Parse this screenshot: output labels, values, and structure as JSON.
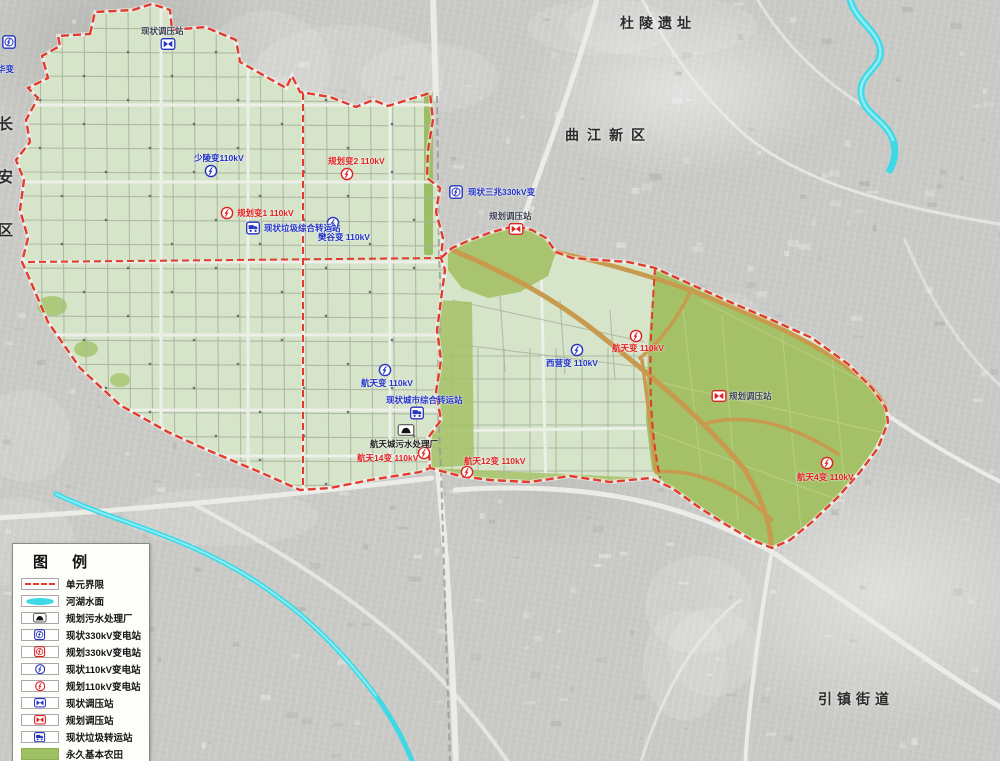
{
  "legend": {
    "title": "图 例",
    "items": [
      {
        "id": "unit-boundary",
        "swatch": "dashed-line",
        "label": "单元界限"
      },
      {
        "id": "water-surface",
        "swatch": "water",
        "label": "河湖水面"
      },
      {
        "id": "sewage-plant-planned",
        "swatch": "sewage",
        "label": "规划污水处理厂"
      },
      {
        "id": "substation-330-existing",
        "swatch": "sub330-blue",
        "label": "现状330kV变电站"
      },
      {
        "id": "substation-330-planned",
        "swatch": "sub330-red",
        "label": "规划330kV变电站"
      },
      {
        "id": "substation-110-existing",
        "swatch": "sub110-blue",
        "label": "现状110kV变电站"
      },
      {
        "id": "substation-110-planned",
        "swatch": "sub110-red",
        "label": "规划110kV变电站"
      },
      {
        "id": "regulator-existing",
        "swatch": "reg-blue",
        "label": "现状调压站"
      },
      {
        "id": "regulator-planned",
        "swatch": "reg-red",
        "label": "规划调压站"
      },
      {
        "id": "garbage-transfer-existing",
        "swatch": "garbage-blue",
        "label": "现状垃圾转运站"
      },
      {
        "id": "permanent-farmland",
        "swatch": "farmland",
        "label": "永久基本农田"
      }
    ]
  },
  "map": {
    "place_labels": [
      {
        "id": "duling-ruins",
        "text": "杜陵遗址",
        "x": 620,
        "y": 13,
        "size": 14,
        "spacing": 5,
        "vertical": false
      },
      {
        "id": "qujiang-new-district",
        "text": "曲江新区",
        "x": 565,
        "y": 125,
        "size": 14,
        "spacing": 8,
        "vertical": false
      },
      {
        "id": "yinzhen-subdistrict",
        "text": "引镇街道",
        "x": 818,
        "y": 689,
        "size": 14,
        "spacing": 5,
        "vertical": false
      },
      {
        "id": "changan-district",
        "text": "长安区",
        "x": -6,
        "y": 116,
        "size": 15,
        "spacing": 38,
        "vertical": true
      }
    ],
    "markers": [
      {
        "id": "substation-west-edge",
        "icon": "sub330",
        "color": "blue",
        "x": 9,
        "y": 42,
        "label": "华变",
        "lx": -3,
        "ly": 63,
        "lc": "blue"
      },
      {
        "id": "regulator-existing-north",
        "icon": "regulator",
        "color": "blue",
        "x": 168,
        "y": 44,
        "label": "现状调压站",
        "lx": 141,
        "ly": 25,
        "lc": "dark"
      },
      {
        "id": "substation-110-shaoling",
        "icon": "sub110",
        "color": "blue",
        "x": 211,
        "y": 171,
        "label": "少陵变110kV",
        "lx": 194,
        "ly": 152,
        "lc": "blue"
      },
      {
        "id": "substation-110-planned-2",
        "icon": "sub110",
        "color": "red",
        "x": 347,
        "y": 174,
        "label": "规划变2 110kV",
        "lx": 328,
        "ly": 155,
        "lc": "red"
      },
      {
        "id": "substation-110-planned-1",
        "icon": "sub110",
        "color": "red",
        "x": 227,
        "y": 213,
        "label": "规划变1 110kV",
        "lx": 237,
        "ly": 207,
        "lc": "red"
      },
      {
        "id": "garbage-transfer-existing",
        "icon": "garbage",
        "color": "blue",
        "x": 253,
        "y": 228,
        "label": "现状垃圾综合转运站",
        "lx": 264,
        "ly": 222,
        "lc": "blue"
      },
      {
        "id": "substation-110-fangu",
        "icon": "sub110",
        "color": "blue",
        "x": 333,
        "y": 223,
        "label": "樊谷变 110kV",
        "lx": 318,
        "ly": 231,
        "lc": "blue"
      },
      {
        "id": "substation-330-sanzhao",
        "icon": "sub330",
        "color": "blue",
        "x": 456,
        "y": 192,
        "label": "现状三兆330kV变",
        "lx": 468,
        "ly": 186,
        "lc": "blue"
      },
      {
        "id": "regulator-planned-north",
        "icon": "regulator",
        "color": "red",
        "x": 516,
        "y": 229,
        "label": "规划调压站",
        "lx": 489,
        "ly": 210,
        "lc": "dark"
      },
      {
        "id": "substation-110-hangtian",
        "icon": "sub110",
        "color": "blue",
        "x": 385,
        "y": 370,
        "label": "航天变 110kV",
        "lx": 361,
        "ly": 377,
        "lc": "blue"
      },
      {
        "id": "garbage-transfer-city",
        "icon": "garbage",
        "color": "blue",
        "x": 417,
        "y": 413,
        "label": "现状城市综合转运站",
        "lx": 386,
        "ly": 394,
        "lc": "blue"
      },
      {
        "id": "sewage-plant-hangtian",
        "icon": "sewage",
        "color": "black",
        "x": 406,
        "y": 430,
        "label": "航天城污水处理厂",
        "lx": 370,
        "ly": 438,
        "lc": "black"
      },
      {
        "id": "substation-110-hangtian-14",
        "icon": "sub110",
        "color": "red",
        "x": 424,
        "y": 453,
        "label": "航天14变 110kV",
        "lx": 357,
        "ly": 452,
        "lc": "red"
      },
      {
        "id": "substation-110-hangtian-12",
        "icon": "sub110",
        "color": "red",
        "x": 467,
        "y": 472,
        "label": "航天12变 110kV",
        "lx": 464,
        "ly": 455,
        "lc": "red"
      },
      {
        "id": "substation-110-xiying",
        "icon": "sub110",
        "color": "blue",
        "x": 577,
        "y": 350,
        "label": "西营变 110kV",
        "lx": 546,
        "ly": 357,
        "lc": "blue"
      },
      {
        "id": "substation-110-hangtian-planned",
        "icon": "sub110",
        "color": "red",
        "x": 636,
        "y": 336,
        "label": "航天变 110kV",
        "lx": 612,
        "ly": 342,
        "lc": "red"
      },
      {
        "id": "regulator-planned-east",
        "icon": "regulator",
        "color": "red",
        "x": 719,
        "y": 396,
        "label": "规划调压站",
        "lx": 729,
        "ly": 390,
        "lc": "dark"
      },
      {
        "id": "substation-110-hangtian-4",
        "icon": "sub110",
        "color": "red",
        "x": 827,
        "y": 463,
        "label": "航天4变 110kV",
        "lx": 797,
        "ly": 471,
        "lc": "red"
      }
    ]
  },
  "colors": {
    "boundary_red": "#e23b2e",
    "existing_blue": "#2433c0",
    "planned_red": "#e01f1f",
    "water_cyan": "#3fd9e6",
    "farmland_green": "#9dc162",
    "plan_area_green": "#d6e4c9",
    "road_orange": "#c89a4e"
  }
}
